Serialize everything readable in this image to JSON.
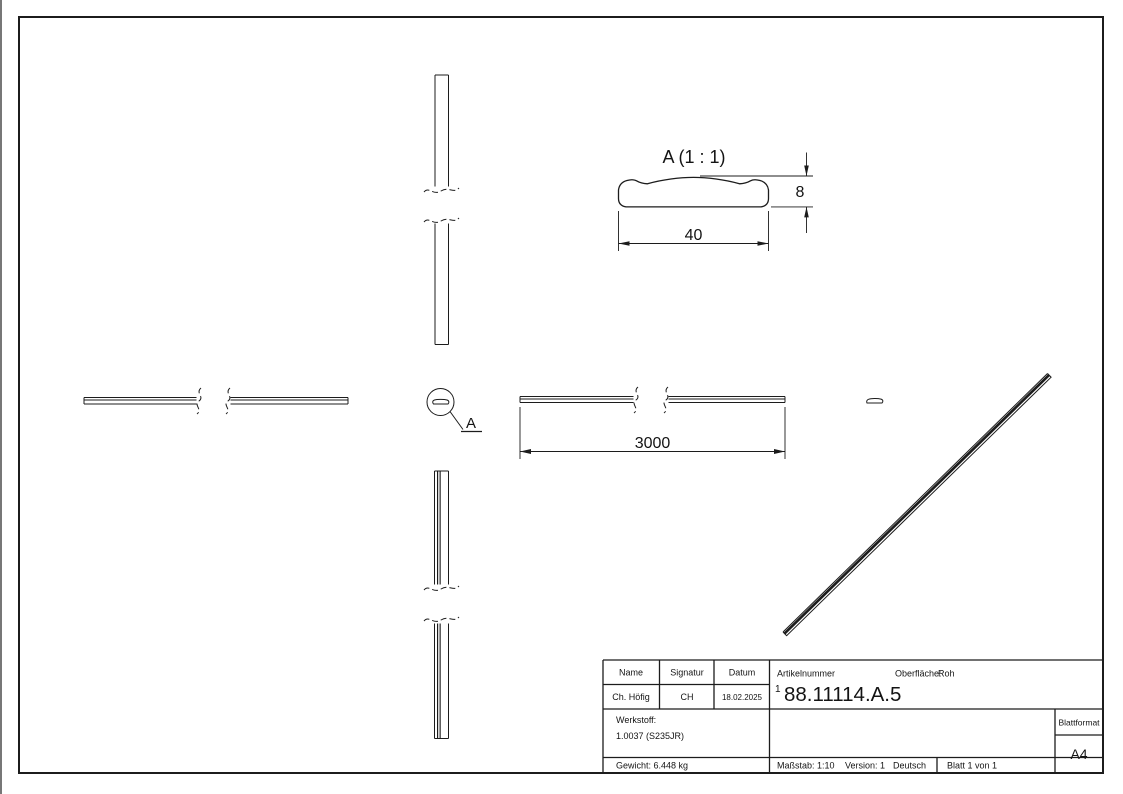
{
  "drawing": {
    "detail_view_label": "A (1 : 1)",
    "detail_callout_letter": "A",
    "dim_width": "40",
    "dim_height": "8",
    "dim_length": "3000"
  },
  "title_block": {
    "col_name": {
      "header": "Name",
      "value": "Ch. Höfig"
    },
    "col_signatur": {
      "header": "Signatur",
      "value": "CH"
    },
    "col_datum": {
      "header": "Datum",
      "value": "18.02.2025"
    },
    "artikelnummer": {
      "label": "Artikelnummer",
      "prefix": "1",
      "number": "88.11114.A.5"
    },
    "oberflaeche": {
      "label": "Oberfläche:",
      "value": "Roh"
    },
    "werkstoff": {
      "label": "Werkstoff:",
      "value": "1.0037 (S235JR)"
    },
    "gewicht": "Gewicht: 6.448 kg",
    "massstab": "Maßstab: 1:10",
    "version": "Version: 1",
    "sprache": "Deutsch",
    "blatt": "Blatt 1 von 1",
    "blattformat": {
      "label": "Blattformat",
      "value": "A4"
    }
  },
  "colors": {
    "line": "#1c1c1c",
    "background": "#ffffff"
  }
}
